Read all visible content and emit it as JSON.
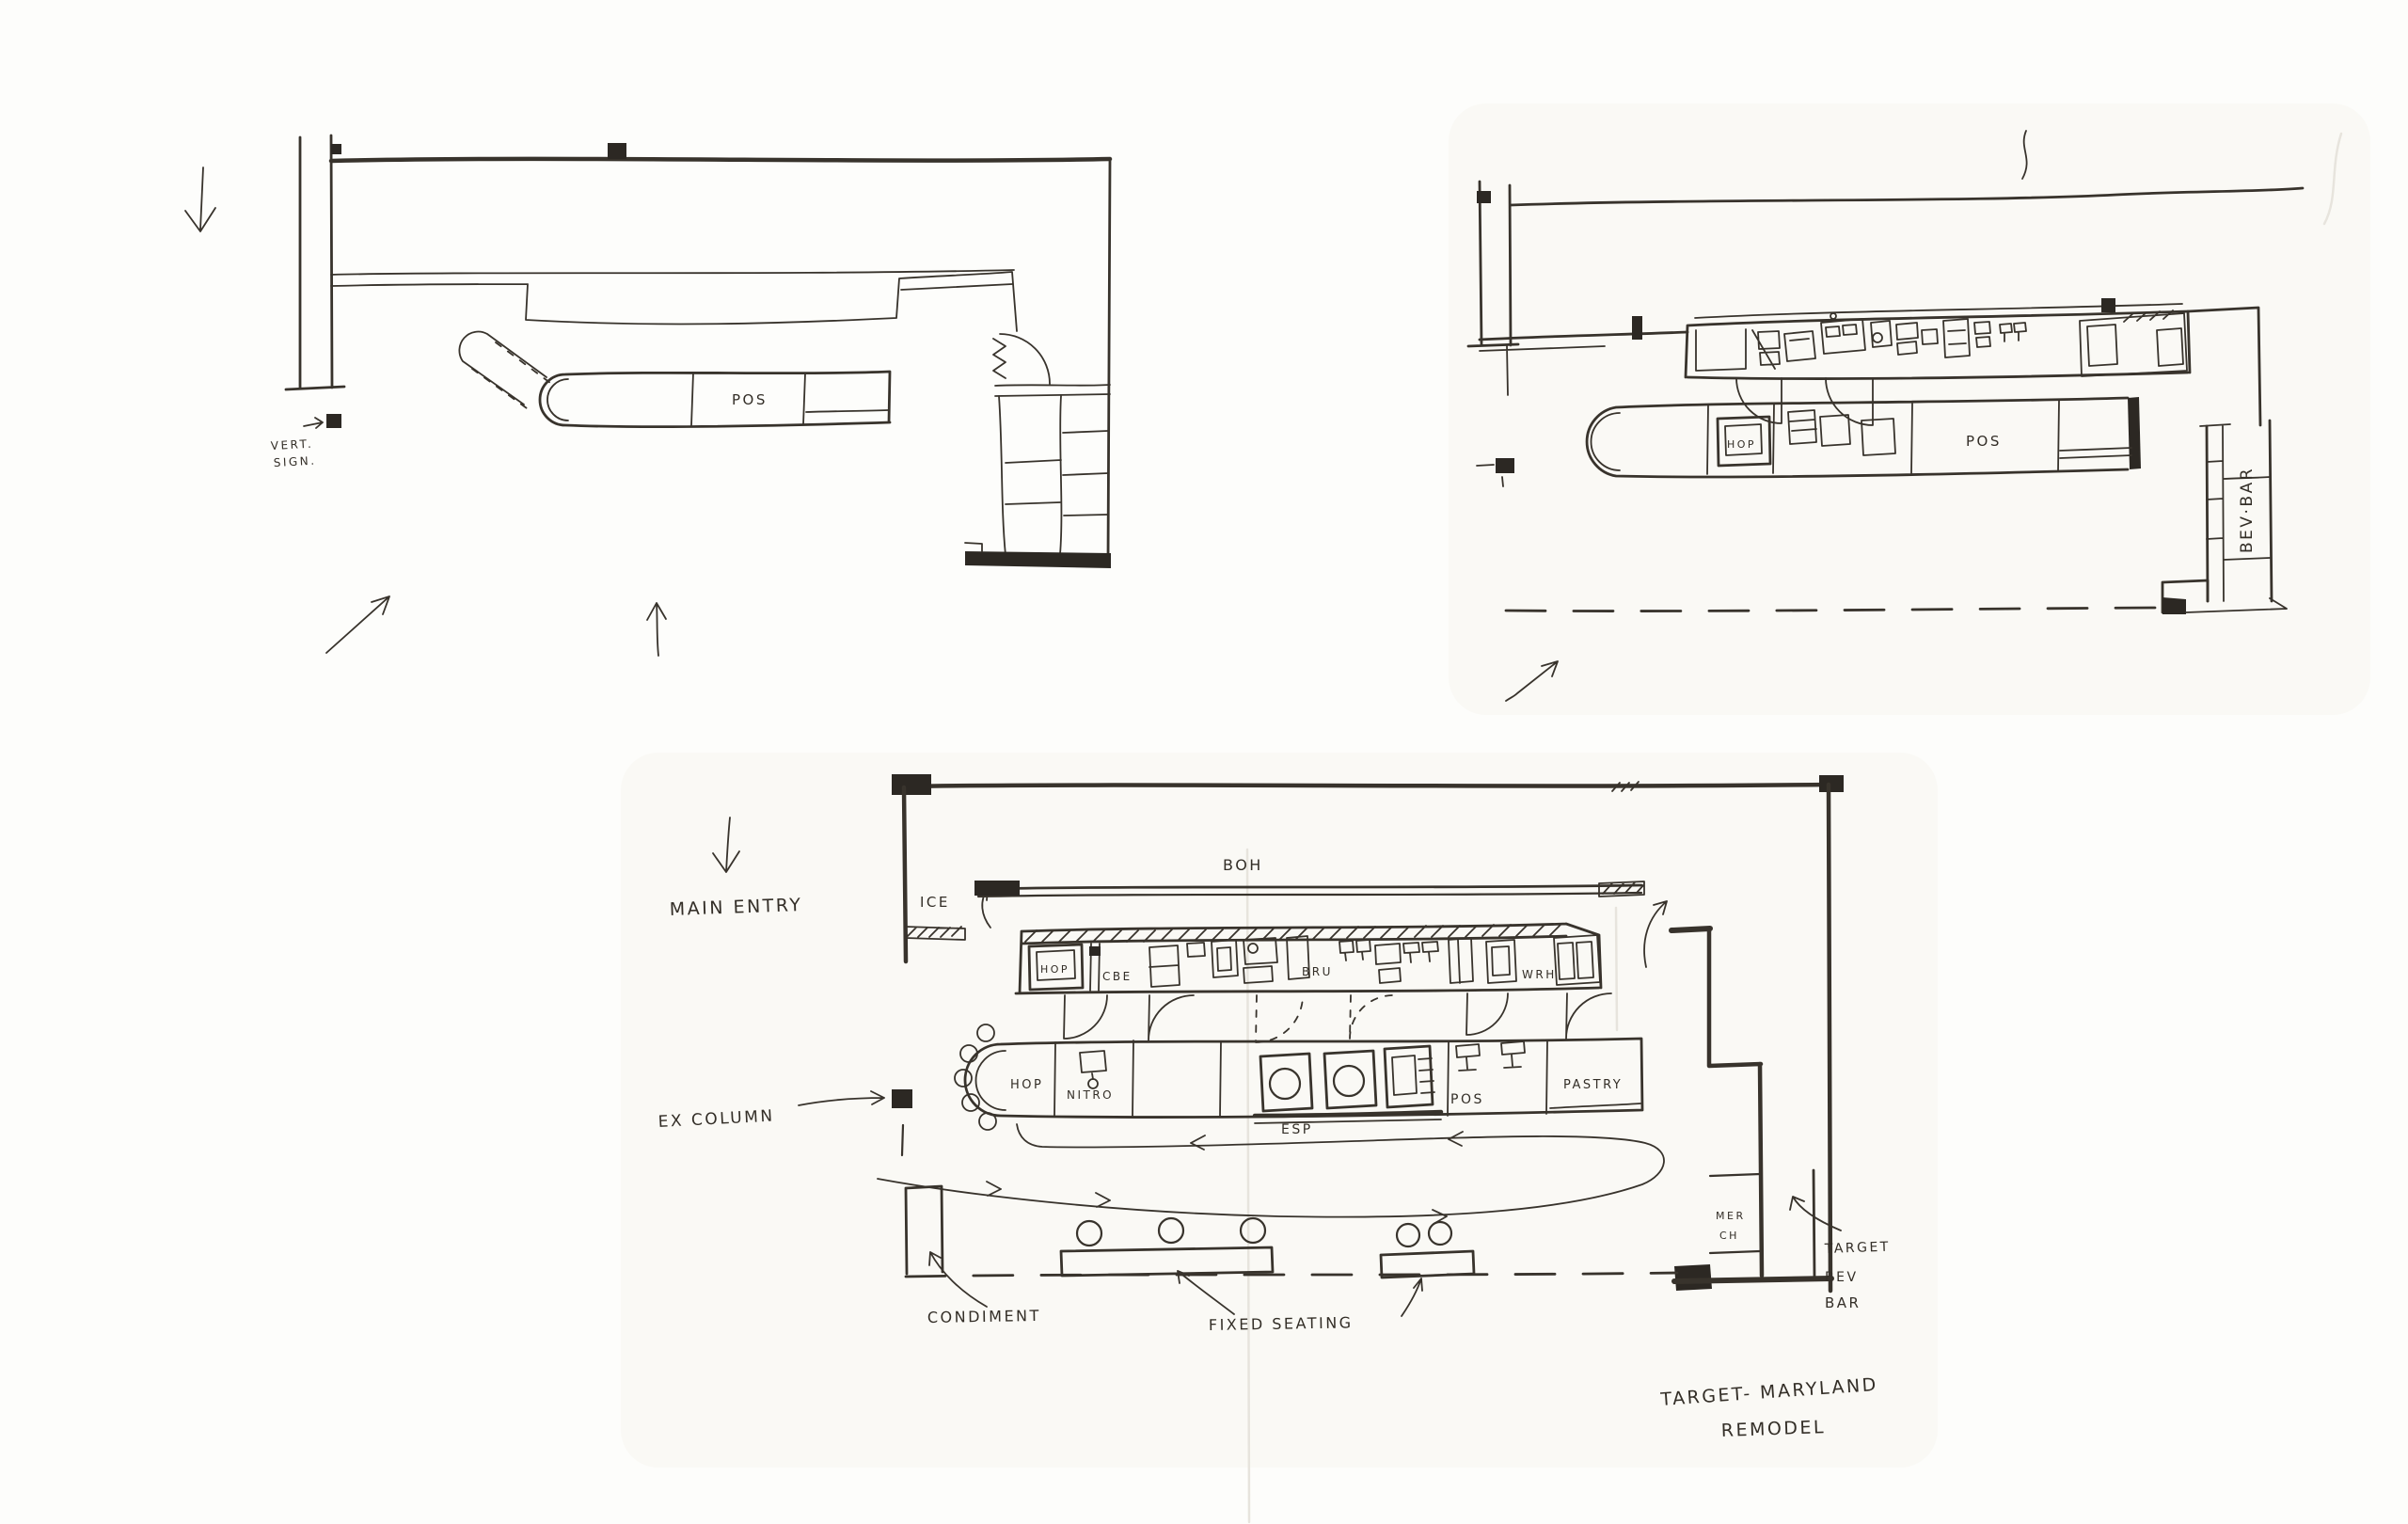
{
  "palette": {
    "paper": "#fdfdfb",
    "ink": "#38332c",
    "black_fill": "#2c2823",
    "crease": "#e7e4dd"
  },
  "sketch_top_left": {
    "labels": {
      "pos": "POS",
      "vert_sign_line1": "VERT.",
      "vert_sign_line2": "SIGN."
    }
  },
  "sketch_top_right": {
    "labels": {
      "hop": "HOP",
      "pos": "POS",
      "bev_bar": "BEV·BAR"
    }
  },
  "sketch_bottom": {
    "labels": {
      "main_entry": "MAIN ENTRY",
      "ice": "ICE",
      "boh": "BOH",
      "hop_back": "HOP",
      "cbe": "CBE",
      "bru": "BRU",
      "wrh": "WRH",
      "hop_front": "HOP",
      "nitro": "NITRO",
      "esp": "ESP",
      "pos": "POS",
      "pastry": "PASTRY",
      "ex_column": "EX COLUMN",
      "condiment": "CONDIMENT",
      "fixed_seating": "FIXED SEATING",
      "merch_line1": "MER",
      "merch_line2": "CH",
      "target_bev_line1": "TARGET",
      "target_bev_line2": "BEV",
      "target_bev_line3": "BAR"
    },
    "title_line1": "TARGET- MARYLAND",
    "title_line2": "REMODEL"
  }
}
